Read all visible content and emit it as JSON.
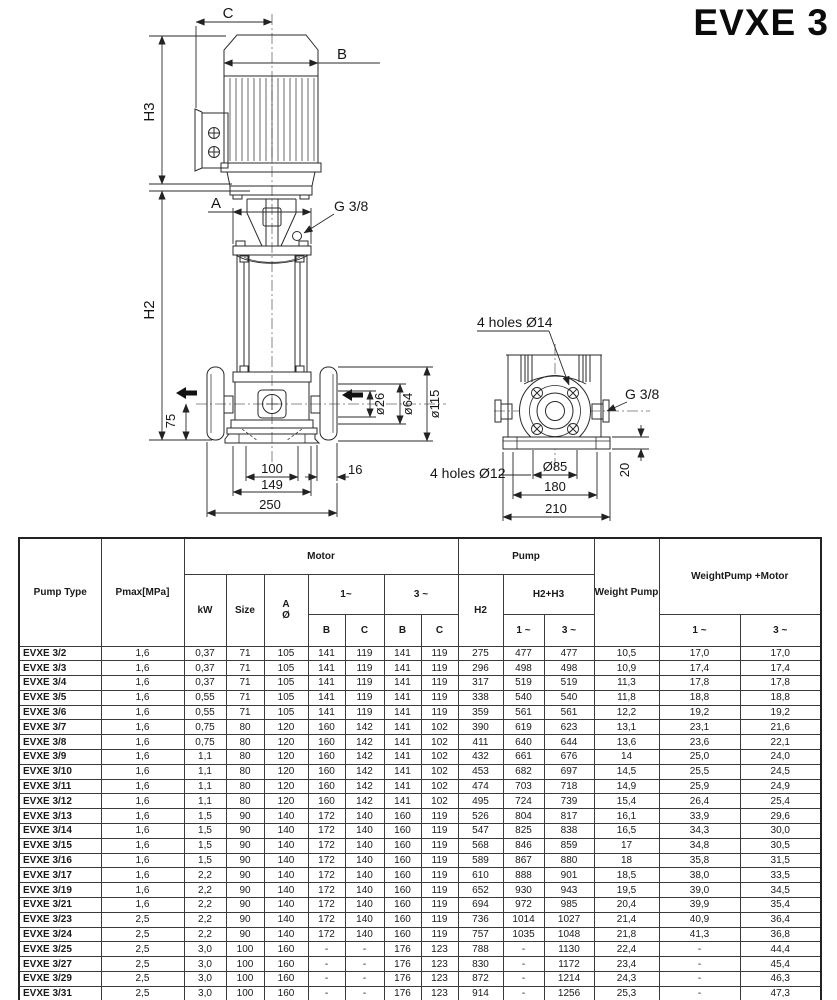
{
  "title": "EVXE 3",
  "diagram": {
    "front": {
      "c": "C",
      "b": "B",
      "a": "A",
      "h3": "H3",
      "h2": "H2",
      "g38": "G 3/8",
      "d75": "75",
      "dia26": "ø26",
      "dia64": "ø64",
      "dia115": "ø115",
      "d100": "100",
      "d149": "149",
      "d250": "250",
      "d16": "16"
    },
    "side": {
      "holes14": "4 holes Ø14",
      "holes12": "4 holes Ø12",
      "g38": "G 3/8",
      "dia85": "Ø85",
      "d180": "180",
      "d210": "210",
      "d20": "20"
    }
  },
  "table": {
    "headers": {
      "pump_type": "Pump Type",
      "pmax": "Pmax[MPa]",
      "motor": "Motor",
      "pump": "Pump",
      "kw": "kW",
      "size": "Size",
      "a": "A",
      "dia": "Ø",
      "m1": "1~",
      "m3": "3 ~",
      "b": "B",
      "c": "C",
      "h2": "H2",
      "h2h3": "H2+H3",
      "p1": "1 ~",
      "p3": "3 ~",
      "weight_pump": "Weight Pump",
      "weight_pump_motor": "WeightPump +Motor",
      "w1": "1 ~",
      "w3": "3 ~"
    },
    "rows": [
      [
        "EVXE 3/2",
        "1,6",
        "0,37",
        "71",
        "105",
        "141",
        "119",
        "141",
        "119",
        "275",
        "477",
        "477",
        "10,5",
        "17,0",
        "17,0"
      ],
      [
        "EVXE 3/3",
        "1,6",
        "0,37",
        "71",
        "105",
        "141",
        "119",
        "141",
        "119",
        "296",
        "498",
        "498",
        "10,9",
        "17,4",
        "17,4"
      ],
      [
        "EVXE 3/4",
        "1,6",
        "0,37",
        "71",
        "105",
        "141",
        "119",
        "141",
        "119",
        "317",
        "519",
        "519",
        "11,3",
        "17,8",
        "17,8"
      ],
      [
        "EVXE 3/5",
        "1,6",
        "0,55",
        "71",
        "105",
        "141",
        "119",
        "141",
        "119",
        "338",
        "540",
        "540",
        "11,8",
        "18,8",
        "18,8"
      ],
      [
        "EVXE 3/6",
        "1,6",
        "0,55",
        "71",
        "105",
        "141",
        "119",
        "141",
        "119",
        "359",
        "561",
        "561",
        "12,2",
        "19,2",
        "19,2"
      ],
      [
        "EVXE 3/7",
        "1,6",
        "0,75",
        "80",
        "120",
        "160",
        "142",
        "141",
        "102",
        "390",
        "619",
        "623",
        "13,1",
        "23,1",
        "21,6"
      ],
      [
        "EVXE 3/8",
        "1,6",
        "0,75",
        "80",
        "120",
        "160",
        "142",
        "141",
        "102",
        "411",
        "640",
        "644",
        "13,6",
        "23,6",
        "22,1"
      ],
      [
        "EVXE 3/9",
        "1,6",
        "1,1",
        "80",
        "120",
        "160",
        "142",
        "141",
        "102",
        "432",
        "661",
        "676",
        "14",
        "25,0",
        "24,0"
      ],
      [
        "EVXE 3/10",
        "1,6",
        "1,1",
        "80",
        "120",
        "160",
        "142",
        "141",
        "102",
        "453",
        "682",
        "697",
        "14,5",
        "25,5",
        "24,5"
      ],
      [
        "EVXE 3/11",
        "1,6",
        "1,1",
        "80",
        "120",
        "160",
        "142",
        "141",
        "102",
        "474",
        "703",
        "718",
        "14,9",
        "25,9",
        "24,9"
      ],
      [
        "EVXE 3/12",
        "1,6",
        "1,1",
        "80",
        "120",
        "160",
        "142",
        "141",
        "102",
        "495",
        "724",
        "739",
        "15,4",
        "26,4",
        "25,4"
      ],
      [
        "EVXE 3/13",
        "1,6",
        "1,5",
        "90",
        "140",
        "172",
        "140",
        "160",
        "119",
        "526",
        "804",
        "817",
        "16,1",
        "33,9",
        "29,6"
      ],
      [
        "EVXE 3/14",
        "1,6",
        "1,5",
        "90",
        "140",
        "172",
        "140",
        "160",
        "119",
        "547",
        "825",
        "838",
        "16,5",
        "34,3",
        "30,0"
      ],
      [
        "EVXE 3/15",
        "1,6",
        "1,5",
        "90",
        "140",
        "172",
        "140",
        "160",
        "119",
        "568",
        "846",
        "859",
        "17",
        "34,8",
        "30,5"
      ],
      [
        "EVXE 3/16",
        "1,6",
        "1,5",
        "90",
        "140",
        "172",
        "140",
        "160",
        "119",
        "589",
        "867",
        "880",
        "18",
        "35,8",
        "31,5"
      ],
      [
        "EVXE 3/17",
        "1,6",
        "2,2",
        "90",
        "140",
        "172",
        "140",
        "160",
        "119",
        "610",
        "888",
        "901",
        "18,5",
        "38,0",
        "33,5"
      ],
      [
        "EVXE 3/19",
        "1,6",
        "2,2",
        "90",
        "140",
        "172",
        "140",
        "160",
        "119",
        "652",
        "930",
        "943",
        "19,5",
        "39,0",
        "34,5"
      ],
      [
        "EVXE 3/21",
        "1,6",
        "2,2",
        "90",
        "140",
        "172",
        "140",
        "160",
        "119",
        "694",
        "972",
        "985",
        "20,4",
        "39,9",
        "35,4"
      ],
      [
        "EVXE 3/23",
        "2,5",
        "2,2",
        "90",
        "140",
        "172",
        "140",
        "160",
        "119",
        "736",
        "1014",
        "1027",
        "21,4",
        "40,9",
        "36,4"
      ],
      [
        "EVXE 3/24",
        "2,5",
        "2,2",
        "90",
        "140",
        "172",
        "140",
        "160",
        "119",
        "757",
        "1035",
        "1048",
        "21,8",
        "41,3",
        "36,8"
      ],
      [
        "EVXE 3/25",
        "2,5",
        "3,0",
        "100",
        "160",
        "-",
        "-",
        "176",
        "123",
        "788",
        "-",
        "1130",
        "22,4",
        "-",
        "44,4"
      ],
      [
        "EVXE 3/27",
        "2,5",
        "3,0",
        "100",
        "160",
        "-",
        "-",
        "176",
        "123",
        "830",
        "-",
        "1172",
        "23,4",
        "-",
        "45,4"
      ],
      [
        "EVXE 3/29",
        "2,5",
        "3,0",
        "100",
        "160",
        "-",
        "-",
        "176",
        "123",
        "872",
        "-",
        "1214",
        "24,3",
        "-",
        "46,3"
      ],
      [
        "EVXE 3/31",
        "2,5",
        "3,0",
        "100",
        "160",
        "-",
        "-",
        "176",
        "123",
        "914",
        "-",
        "1256",
        "25,3",
        "-",
        "47,3"
      ],
      [
        "EVXE 3/33",
        "2,5",
        "3,0",
        "100",
        "160",
        "-",
        "-",
        "176",
        "123",
        "956",
        "-",
        "1298",
        "26,1",
        "-",
        "48,1"
      ]
    ]
  }
}
